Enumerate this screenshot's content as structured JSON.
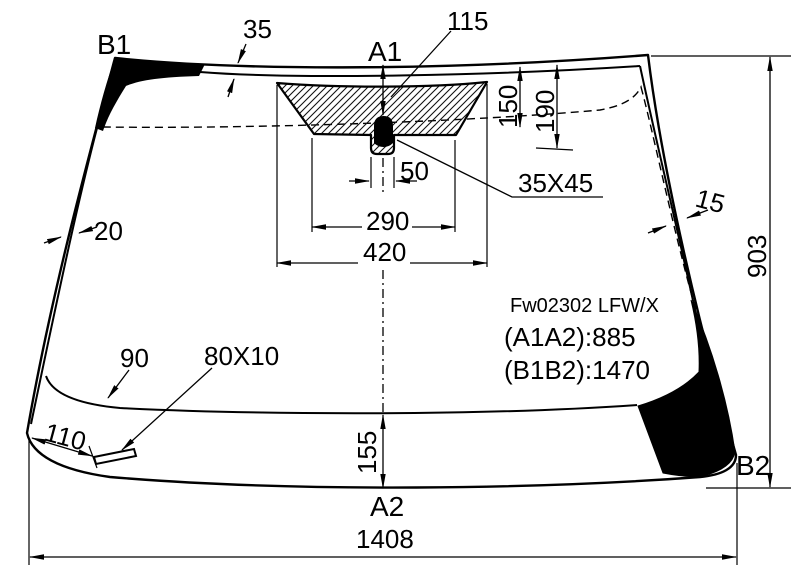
{
  "labels": {
    "b1": "B1",
    "a1": "A1",
    "a2": "A2",
    "b2": "B2"
  },
  "dims": {
    "top_band": "35",
    "sensor_offset": "115",
    "band150": "150",
    "band190": "190",
    "notch": "50",
    "shade_bottom": "290",
    "shade_top": "420",
    "sensor_size": "35X45",
    "left_edge": "20",
    "right_edge": "15",
    "height": "903",
    "bottom_band": "90",
    "mark_size": "80X10",
    "corner_offset": "110",
    "bottom_center": "155",
    "width": "1408"
  },
  "notes": {
    "part": "Fw02302 LFW/X",
    "a1a2": "(A1A2):885",
    "b1b2": "(B1B2):1470"
  },
  "colors": {
    "ink": "#000000",
    "paper": "#ffffff"
  }
}
